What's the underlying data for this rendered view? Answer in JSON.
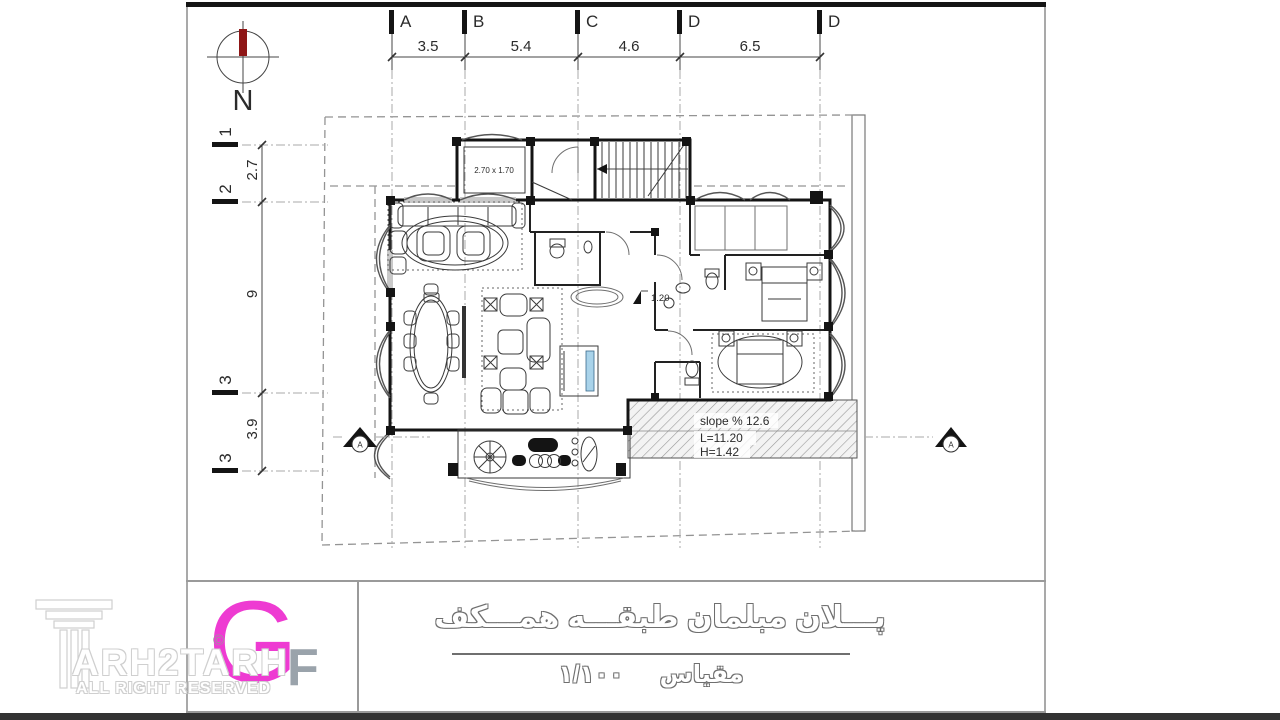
{
  "sheet": {
    "type": "architectural ground floor furniture plan"
  },
  "compass": {
    "label": "N"
  },
  "grid": {
    "columns": [
      {
        "label": "A"
      },
      {
        "label": "B"
      },
      {
        "label": "C"
      },
      {
        "label": "D"
      },
      {
        "label": "D"
      }
    ],
    "column_dims": [
      "3.5",
      "5.4",
      "4.6",
      "6.5"
    ],
    "rows": [
      {
        "label": "1"
      },
      {
        "label": "2"
      },
      {
        "label": "3"
      },
      {
        "label": "3"
      }
    ],
    "row_dims": [
      "2.7",
      "9",
      "3.9"
    ]
  },
  "plan": {
    "elevator_size": "2.70 x 1.70",
    "level_marker": "1.20",
    "ramp": {
      "slope": "slope % 12.6",
      "length": "L=11.20",
      "height": "H=1.42"
    },
    "section_label": "A"
  },
  "titleblock": {
    "logo_letter_g": "G",
    "logo_letter_f": "F",
    "copyright_symbol": "©",
    "drawing_title_fa": "پـــلان مبلمان طبقـــه همـــکف",
    "scale_label_fa": "مقیاس",
    "scale_value_fa": "۱/۱۰۰"
  },
  "watermark": {
    "brand": "ARH2TARH",
    "tagline": "ALL RIGHT RESERVED"
  },
  "colors": {
    "logo_magenta": "#ee3bd2",
    "logo_f_gray": "#9aa3ab",
    "compass_needle_red": "#8e1616",
    "compass_n_magenta": "#cf52e0",
    "tv_screen_blue": "#a9d3ea"
  }
}
